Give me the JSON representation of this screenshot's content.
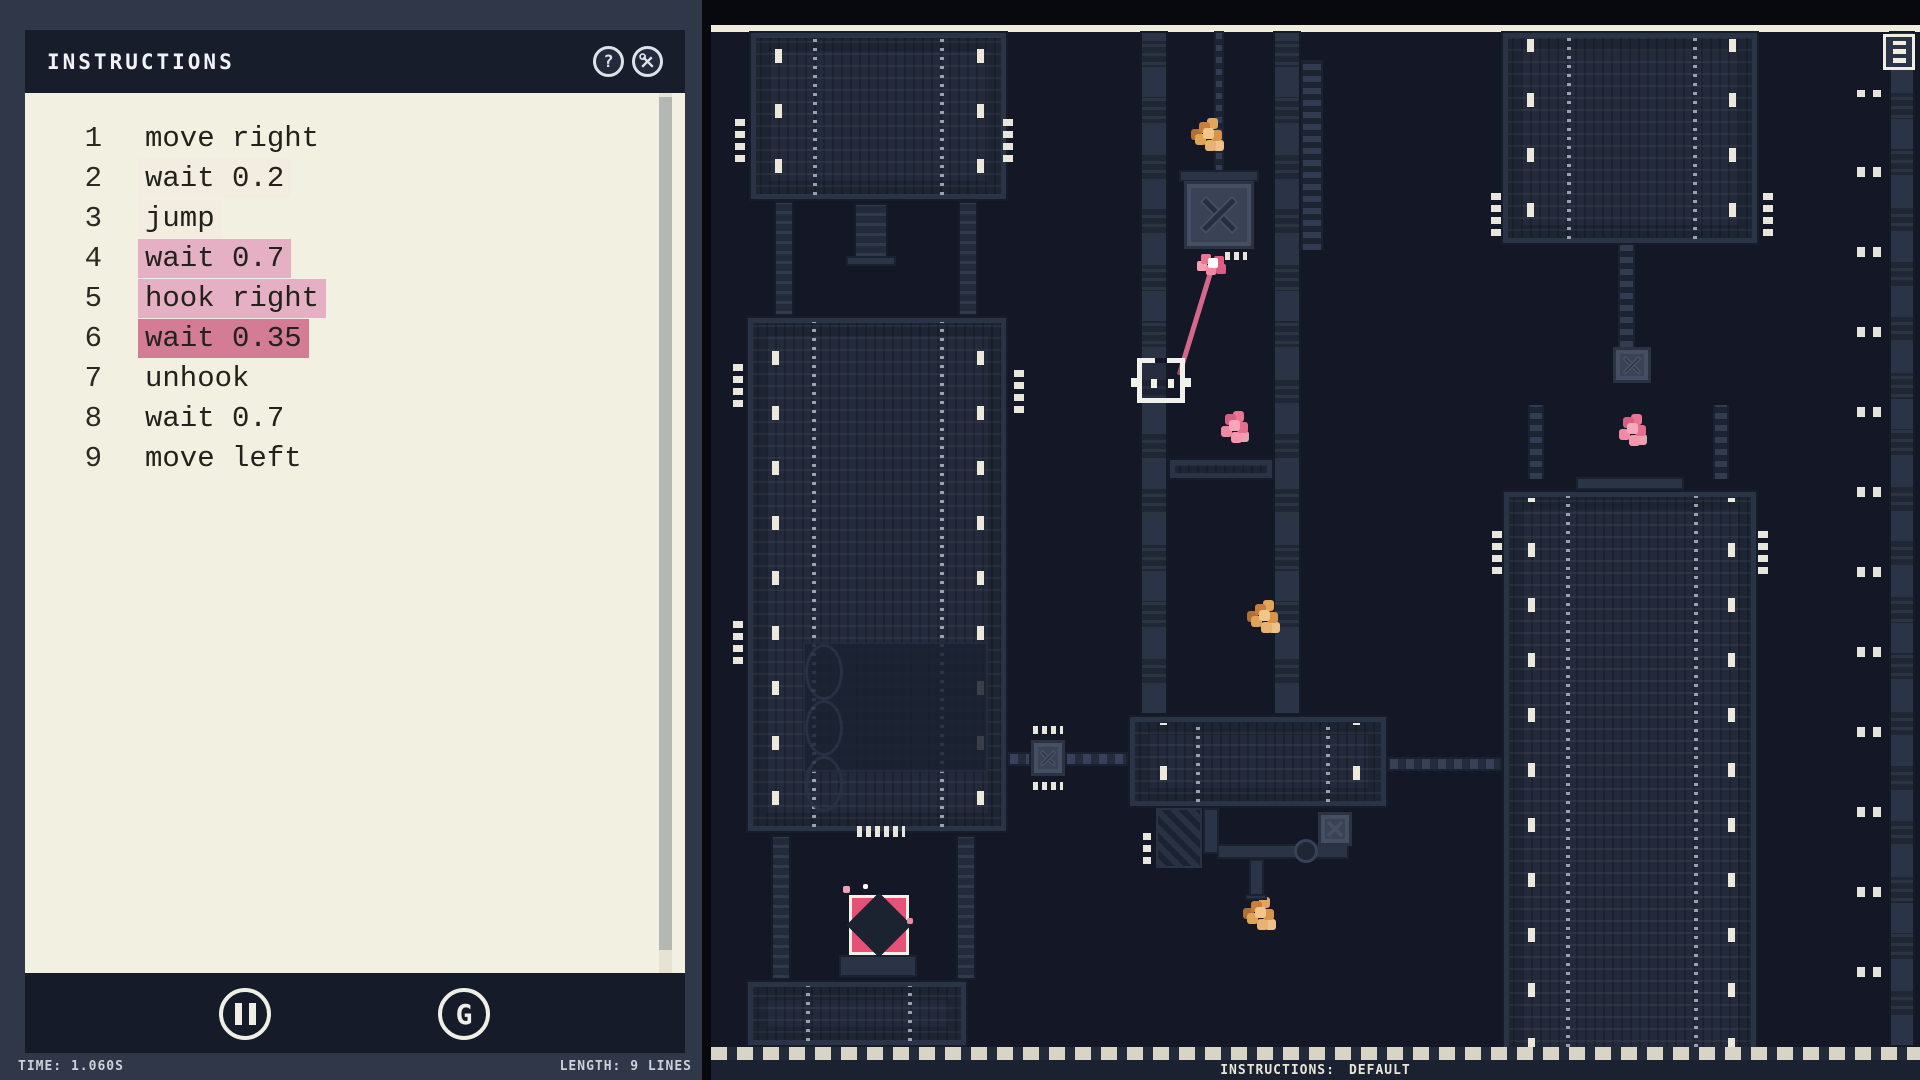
{
  "editor": {
    "title": "INSTRUCTIONS",
    "help_glyph": "?",
    "lines": [
      {
        "num": "1",
        "text": "move right",
        "highlight": "none"
      },
      {
        "num": "2",
        "text": "wait 0.2",
        "highlight": "faint"
      },
      {
        "num": "3",
        "text": "jump",
        "highlight": "faint"
      },
      {
        "num": "4",
        "text": "wait 0.7",
        "highlight": "pink"
      },
      {
        "num": "5",
        "text": "hook right",
        "highlight": "pink"
      },
      {
        "num": "6",
        "text": "wait 0.35",
        "highlight": "active"
      },
      {
        "num": "7",
        "text": "unhook",
        "highlight": "none"
      },
      {
        "num": "8",
        "text": "wait 0.7",
        "highlight": "none"
      },
      {
        "num": "9",
        "text": "move left",
        "highlight": "none"
      }
    ]
  },
  "transport": {
    "restart_glyph": "G"
  },
  "status": {
    "time": "TIME: 1.060S",
    "length": "LENGTH: 9 LINES"
  },
  "game_hud": {
    "label": "INSTRUCTIONS:",
    "value": "DEFAULT"
  },
  "icons": [
    "help-icon",
    "tools-icon",
    "pause-icon",
    "restart-icon",
    "reel-crate-icon"
  ],
  "colors": {
    "accent_pink": "#e85176",
    "rope_pink": "#d4688c",
    "highlight_active": "#d47c96",
    "highlight_step": "#e6b0c4",
    "highlight_faint": "#f3ece1",
    "cream": "#f2f0e0",
    "panel_slate": "#303748",
    "panel_dark": "#171d2b",
    "game_bg": "#141826",
    "tower": "#222a3b",
    "orange": "#e9b273"
  }
}
